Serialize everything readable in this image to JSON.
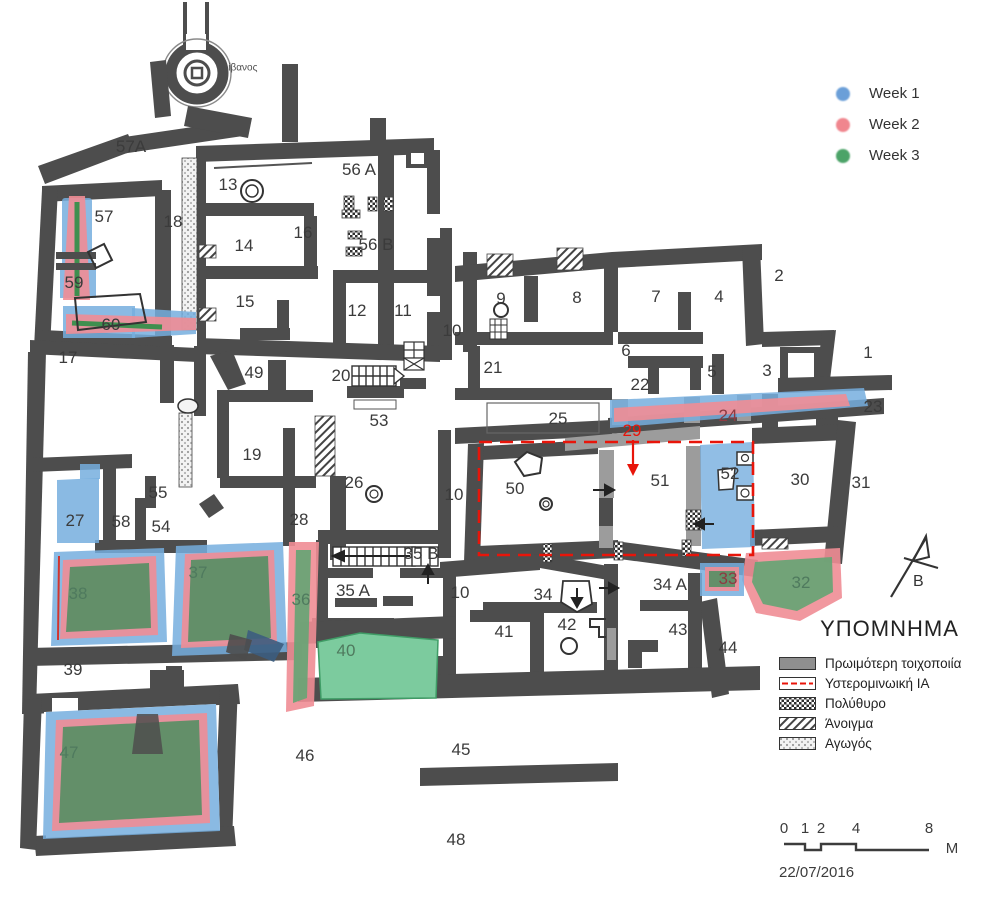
{
  "plan": {
    "kiln_label": "Κλίβανος",
    "rooms": [
      {
        "t": "57A",
        "x": 131,
        "y": 147
      },
      {
        "t": "13",
        "x": 228,
        "y": 185
      },
      {
        "t": "16",
        "x": 303,
        "y": 233
      },
      {
        "t": "56 A",
        "x": 359,
        "y": 170
      },
      {
        "t": "56 B",
        "x": 376,
        "y": 245
      },
      {
        "t": "14",
        "x": 244,
        "y": 246
      },
      {
        "t": "18",
        "x": 173,
        "y": 222
      },
      {
        "t": "57",
        "x": 104,
        "y": 217
      },
      {
        "t": "59",
        "x": 74,
        "y": 283
      },
      {
        "t": "60",
        "x": 111,
        "y": 325
      },
      {
        "t": "15",
        "x": 245,
        "y": 302
      },
      {
        "t": "12",
        "x": 357,
        "y": 311
      },
      {
        "t": "11",
        "x": 403,
        "y": 311
      },
      {
        "t": "10",
        "x": 452,
        "y": 331
      },
      {
        "t": "9",
        "x": 501,
        "y": 299
      },
      {
        "t": "8",
        "x": 577,
        "y": 298
      },
      {
        "t": "7",
        "x": 656,
        "y": 297
      },
      {
        "t": "4",
        "x": 719,
        "y": 297
      },
      {
        "t": "2",
        "x": 779,
        "y": 276
      },
      {
        "t": "17",
        "x": 68,
        "y": 358
      },
      {
        "t": "49",
        "x": 254,
        "y": 373
      },
      {
        "t": "20",
        "x": 341,
        "y": 376
      },
      {
        "t": "21",
        "x": 493,
        "y": 368
      },
      {
        "t": "6",
        "x": 626,
        "y": 351
      },
      {
        "t": "22",
        "x": 640,
        "y": 385
      },
      {
        "t": "5",
        "x": 712,
        "y": 372
      },
      {
        "t": "3",
        "x": 767,
        "y": 371
      },
      {
        "t": "1",
        "x": 868,
        "y": 353
      },
      {
        "t": "23",
        "x": 873,
        "y": 407
      },
      {
        "t": "24",
        "x": 728,
        "y": 416,
        "c": "c-maroon"
      },
      {
        "t": "25",
        "x": 558,
        "y": 419
      },
      {
        "t": "53",
        "x": 379,
        "y": 421
      },
      {
        "t": "29",
        "x": 632,
        "y": 431,
        "c": "c-red"
      },
      {
        "t": "19",
        "x": 252,
        "y": 455
      },
      {
        "t": "26",
        "x": 354,
        "y": 483
      },
      {
        "t": "10",
        "x": 454,
        "y": 495
      },
      {
        "t": "50",
        "x": 515,
        "y": 489
      },
      {
        "t": "51",
        "x": 660,
        "y": 481
      },
      {
        "t": "52",
        "x": 730,
        "y": 474
      },
      {
        "t": "30",
        "x": 800,
        "y": 480
      },
      {
        "t": "31",
        "x": 861,
        "y": 483
      },
      {
        "t": "27",
        "x": 75,
        "y": 521
      },
      {
        "t": "55",
        "x": 158,
        "y": 493
      },
      {
        "t": "58",
        "x": 121,
        "y": 522
      },
      {
        "t": "54",
        "x": 161,
        "y": 527
      },
      {
        "t": "28",
        "x": 299,
        "y": 520
      },
      {
        "t": "38",
        "x": 78,
        "y": 594,
        "c": "c-gm"
      },
      {
        "t": "37",
        "x": 198,
        "y": 573,
        "c": "c-gm"
      },
      {
        "t": "36",
        "x": 301,
        "y": 600,
        "c": "c-gm"
      },
      {
        "t": "35 B",
        "x": 421,
        "y": 554
      },
      {
        "t": "35 A",
        "x": 353,
        "y": 591
      },
      {
        "t": "10",
        "x": 460,
        "y": 593
      },
      {
        "t": "34",
        "x": 543,
        "y": 595
      },
      {
        "t": "34 A",
        "x": 670,
        "y": 585
      },
      {
        "t": "33",
        "x": 728,
        "y": 579,
        "c": "c-maroon"
      },
      {
        "t": "32",
        "x": 801,
        "y": 583,
        "c": "c-gm"
      },
      {
        "t": "40",
        "x": 346,
        "y": 651,
        "c": "c-gm"
      },
      {
        "t": "41",
        "x": 504,
        "y": 632
      },
      {
        "t": "42",
        "x": 567,
        "y": 625
      },
      {
        "t": "43",
        "x": 678,
        "y": 630
      },
      {
        "t": "44",
        "x": 728,
        "y": 648
      },
      {
        "t": "39",
        "x": 73,
        "y": 670
      },
      {
        "t": "47",
        "x": 69,
        "y": 753,
        "c": "c-gm"
      },
      {
        "t": "46",
        "x": 305,
        "y": 756
      },
      {
        "t": "45",
        "x": 461,
        "y": 750
      },
      {
        "t": "48",
        "x": 456,
        "y": 840
      }
    ]
  },
  "legend_weeks": {
    "items": [
      {
        "label": "Week 1",
        "color": "#6b9fd8"
      },
      {
        "label": "Week 2",
        "color": "#f0868e"
      },
      {
        "label": "Week 3",
        "color": "#4ca368"
      }
    ]
  },
  "ypomnima": {
    "title": "ΥΠΟΜΝΗΜΑ",
    "items": [
      {
        "label": "Πρωιμότερη τοιχοποιία",
        "swatch": "gray"
      },
      {
        "label": "Υστερομινωική ΙΑ",
        "swatch": "red-dash"
      },
      {
        "label": "Πολύθυρο",
        "swatch": "crosshatch"
      },
      {
        "label": "Άνοιγμα",
        "swatch": "diagonal"
      },
      {
        "label": "Αγωγός",
        "swatch": "dotted"
      }
    ]
  },
  "scalebar": {
    "ticks": [
      "0",
      "1",
      "2",
      "4",
      "8"
    ],
    "unit": "M"
  },
  "date": "22/07/2016",
  "north": {
    "label": "Β"
  },
  "colors": {
    "walls": "#4d4d4d",
    "early_masonry": "#9c9c9c",
    "lm_ia_red": "#e8150a",
    "week1": "#76aede",
    "week2": "#ef8d95",
    "week3_dark": "#5c8f66",
    "week3_light": "#7ccb9e"
  }
}
